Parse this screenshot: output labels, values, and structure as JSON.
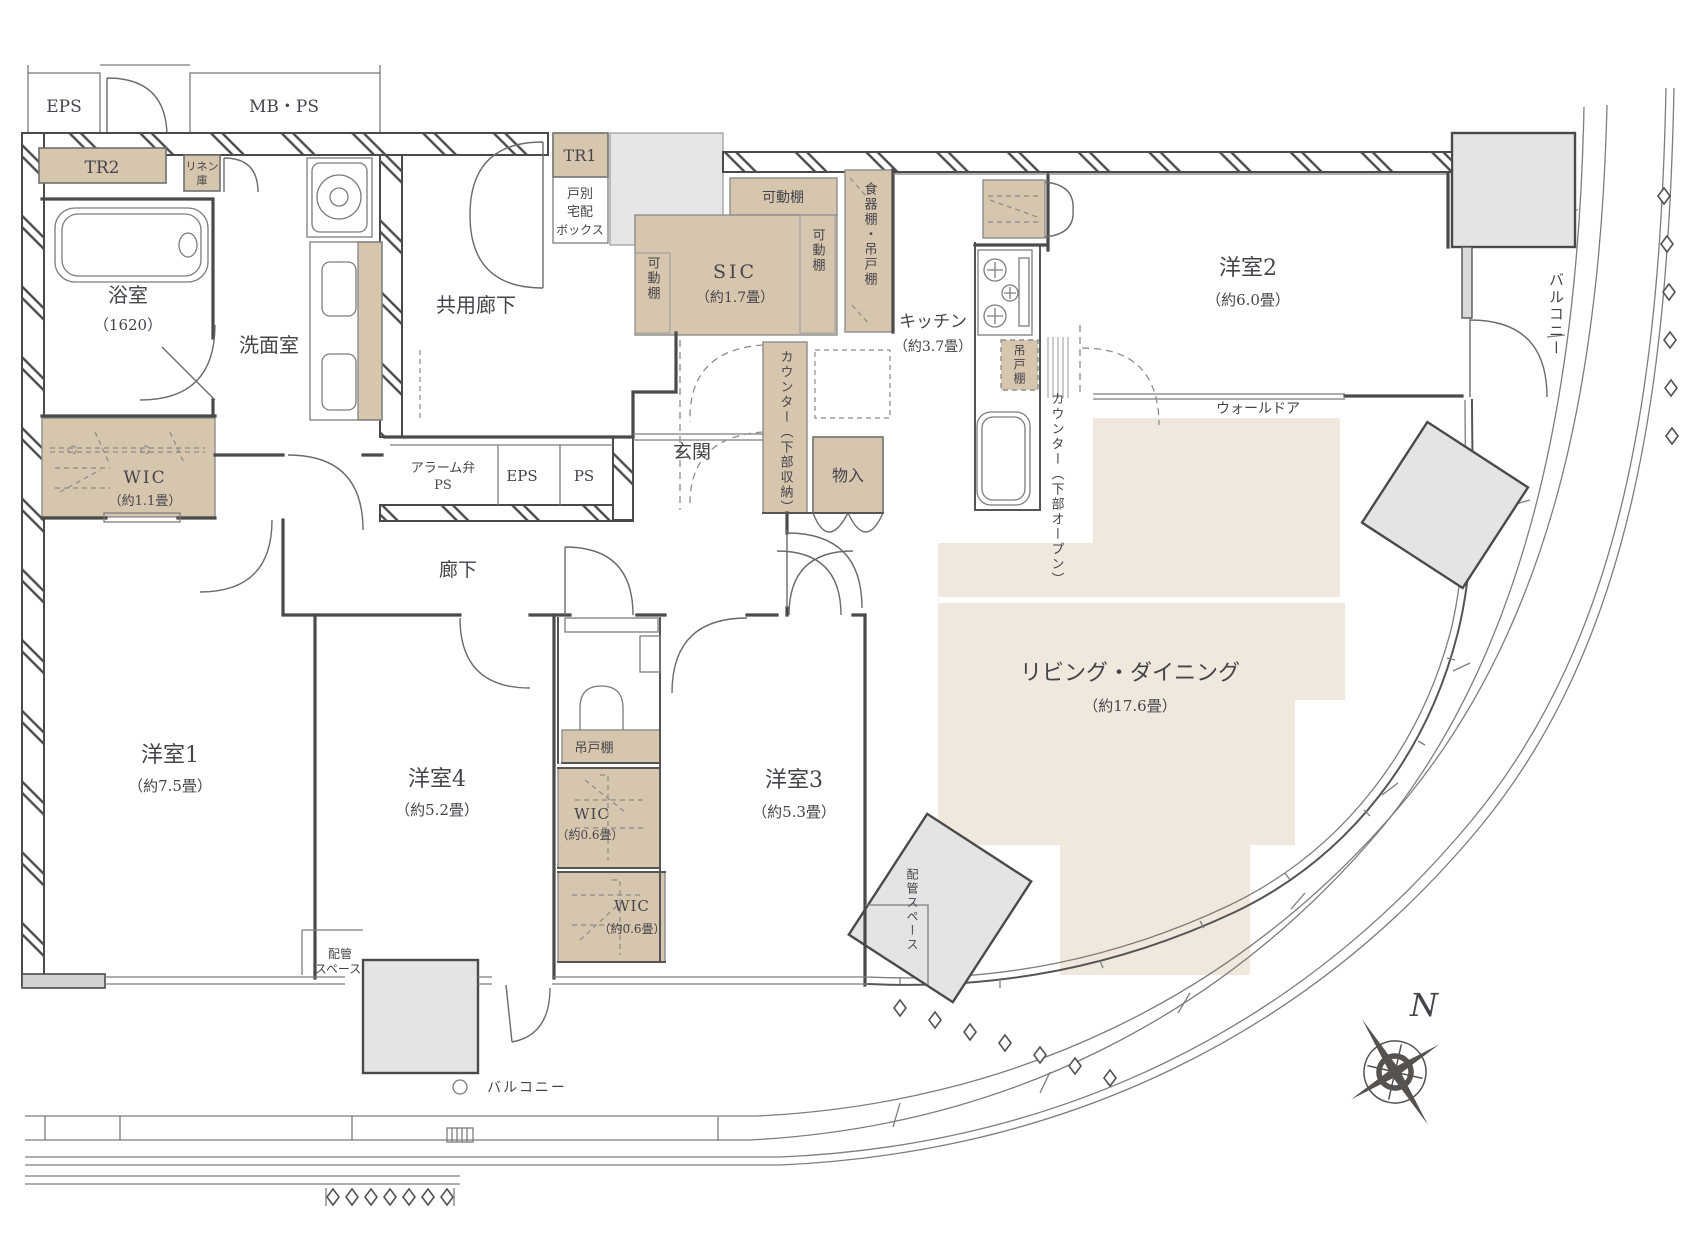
{
  "colors": {
    "storage_beige": "#d7c6ae",
    "living_beige": "#f0e8dc",
    "column_grey": "#e4e4e6",
    "wall": "#4a4a4a"
  },
  "L": {
    "eps_top": "EPS",
    "mbps": "MB・PS",
    "tr2": "TR2",
    "linen_1": "リネン",
    "linen_2": "庫",
    "bath_name": "浴室",
    "bath_size": "（1620）",
    "wash_room": "洗面室",
    "shared_corridor": "共用廊下",
    "tr1": "TR1",
    "parcel_1": "戸別",
    "parcel_2": "宅配",
    "parcel_3": "ボックス",
    "shelf_top": "可動棚",
    "shelf_left": "可動棚",
    "shelf_right": "可動棚",
    "sic_name": "SIC",
    "sic_size": "（約1.7畳）",
    "cupboard": "食器棚・吊戸棚",
    "kitchen_name": "キッチン",
    "kitchen_size": "（約3.7畳）",
    "hang_kitchen": "吊戸棚",
    "counter_open": "カウンター（下部オープン）",
    "yoshitsu2_name": "洋室2",
    "yoshitsu2_size": "（約6.0畳）",
    "balcony_right": "バルコニー",
    "wall_door": "ウォールドア",
    "alarm_1": "アラーム弁",
    "alarm_2": "PS",
    "eps_mid": "EPS",
    "ps_mid": "PS",
    "genkan": "玄関",
    "counter_storage": "カウンター（下部収納）",
    "monoire": "物入",
    "wic1_name": "WIC",
    "wic1_size": "（約1.1畳）",
    "rouka": "廊下",
    "hang_toilet": "吊戸棚",
    "yoshitsu1_name": "洋室1",
    "yoshitsu1_size": "（約7.5畳）",
    "yoshitsu4_name": "洋室4",
    "yoshitsu4_size": "（約5.2畳）",
    "wic_a_name": "WIC",
    "wic_a_size": "（約0.6畳）",
    "wic_b_name": "WIC",
    "wic_b_size": "（約0.6畳）",
    "yoshitsu3_name": "洋室3",
    "yoshitsu3_size": "（約5.3畳）",
    "living_name": "リビング・ダイニング",
    "living_size": "（約17.6畳）",
    "pipe_left_1": "配管",
    "pipe_left_2": "スペース",
    "pipe_right": "配管スペース",
    "balcony_bottom": "バルコニー",
    "compass_n": "N"
  }
}
